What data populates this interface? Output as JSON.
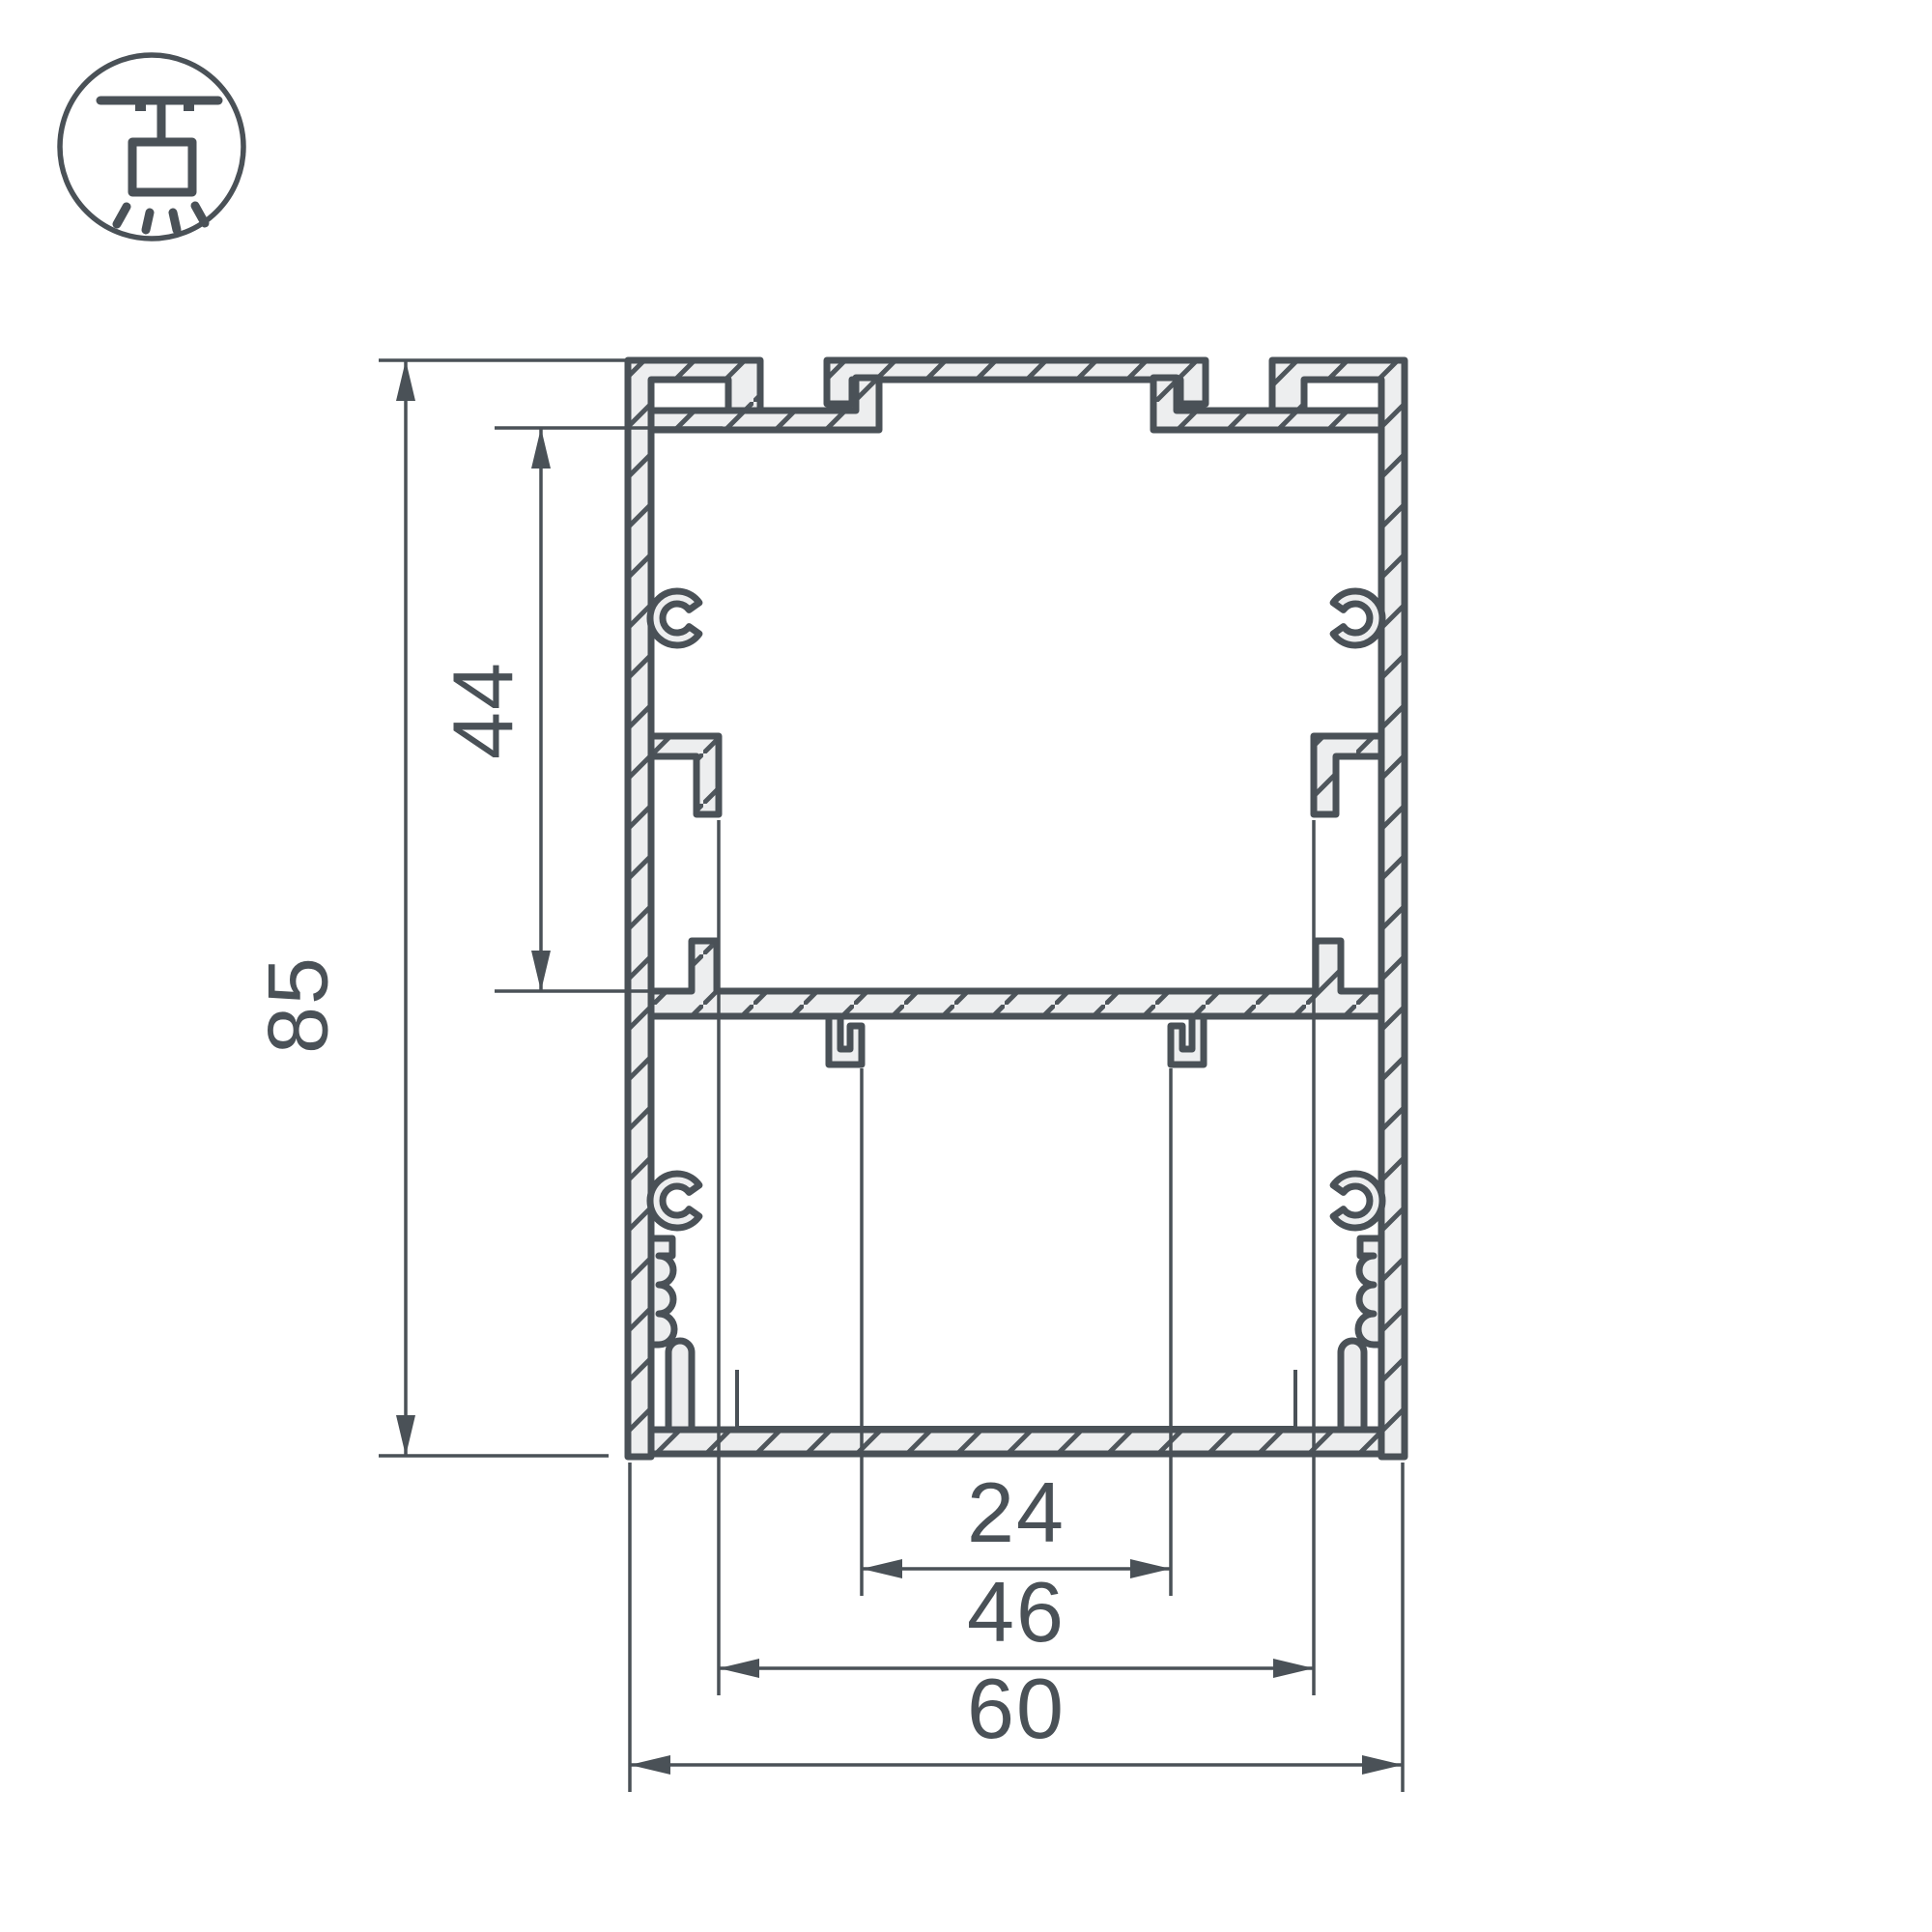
{
  "drawing": {
    "title": "aluminium-led-profile-cross-section",
    "icon": "pendant-ceiling-mount",
    "colors": {
      "line": "#4a5157",
      "fill": "#edeeef",
      "background": "#ffffff"
    },
    "dimensions": {
      "overall_height": "85",
      "inner_height": "44",
      "inner_width": "24",
      "middle_width": "46",
      "overall_width": "60"
    }
  }
}
